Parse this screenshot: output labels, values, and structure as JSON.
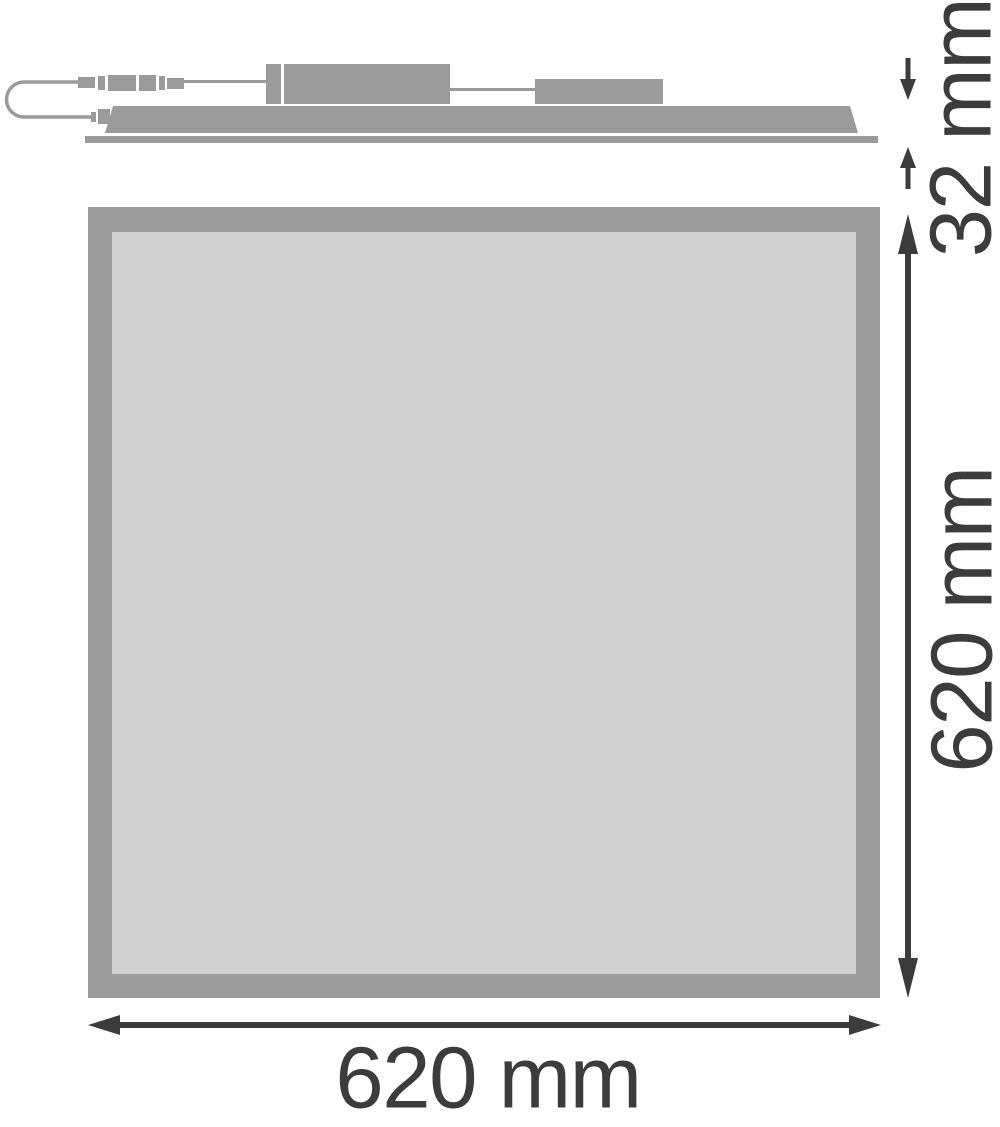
{
  "labels": {
    "profile_height": "32 mm",
    "panel_height": "620 mm",
    "panel_width": "620 mm"
  },
  "colors": {
    "shape": "#9b9b9b",
    "face": "#d2d2d2",
    "dim": "#3c3c3b",
    "bg": "#ffffff"
  }
}
